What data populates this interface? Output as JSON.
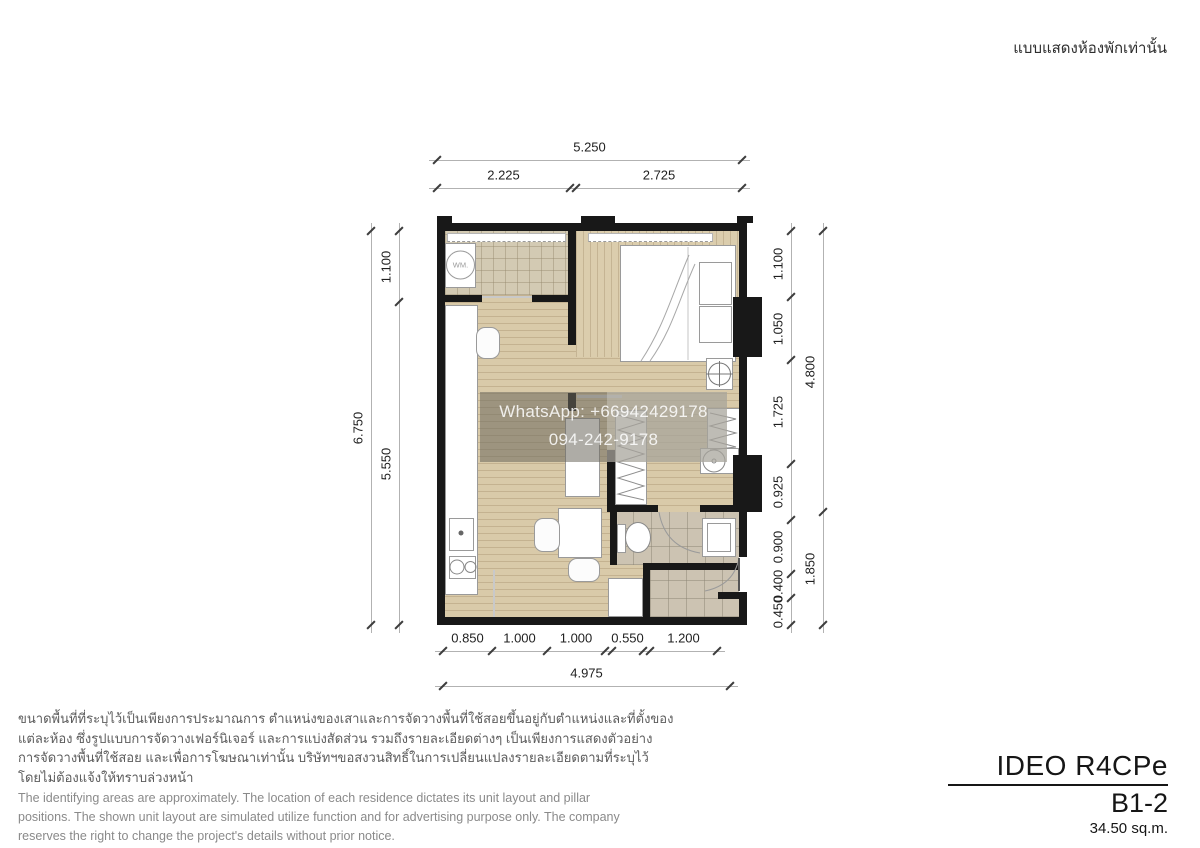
{
  "header": {
    "note_th": "แบบแสดงห้องพักเท่านั้น"
  },
  "watermark": {
    "line1": "WhatsApp: +66942429178",
    "line2": "094-242-9178"
  },
  "plan": {
    "washer": "WM."
  },
  "dimensions": {
    "top": {
      "total": "5.250",
      "parts": [
        "2.225",
        "2.725"
      ]
    },
    "left": {
      "total": "6.750",
      "parts": [
        "1.100",
        "5.550"
      ]
    },
    "right": {
      "outer": [
        "4.800",
        "1.850"
      ],
      "inner": [
        "1.100",
        "1.050",
        "1.725",
        "0.925",
        "0.900",
        "0.400",
        "0.450"
      ]
    },
    "bottom": {
      "total": "4.975",
      "parts": [
        "0.850",
        "1.000",
        "1.000",
        "0.550",
        "1.200"
      ]
    }
  },
  "disclaimer": {
    "thai": [
      "ขนาดพื้นที่ที่ระบุไว้เป็นเพียงการประมาณการ ตำแหน่งของเสาและการจัดวางพื้นที่ใช้สอยขึ้นอยู่กับตำแหน่งและที่ตั้งของ",
      "แต่ละห้อง ซึ่งรูปแบบการจัดวางเฟอร์นิเจอร์ และการแบ่งสัดส่วน รวมถึงรายละเอียดต่างๆ เป็นเพียงการแสดงตัวอย่าง",
      "การจัดวางพื้นที่ใช้สอย และเพื่อการโฆษณาเท่านั้น บริษัทฯขอสงวนสิทธิ์ในการเปลี่ยนแปลงรายละเอียดตามที่ระบุไว้",
      "โดยไม่ต้องแจ้งให้ทราบล่วงหน้า"
    ],
    "english": [
      "The identifying areas are approximately. The location of each residence dictates its unit layout and pillar",
      "positions. The shown unit layout are simulated utilize function and for advertising purpose only. The company",
      "reserves the right to change the project's details without prior notice."
    ]
  },
  "title_block": {
    "project": "IDEO R4CPe",
    "unit": "B1-2",
    "area": "34.50 sq.m."
  }
}
